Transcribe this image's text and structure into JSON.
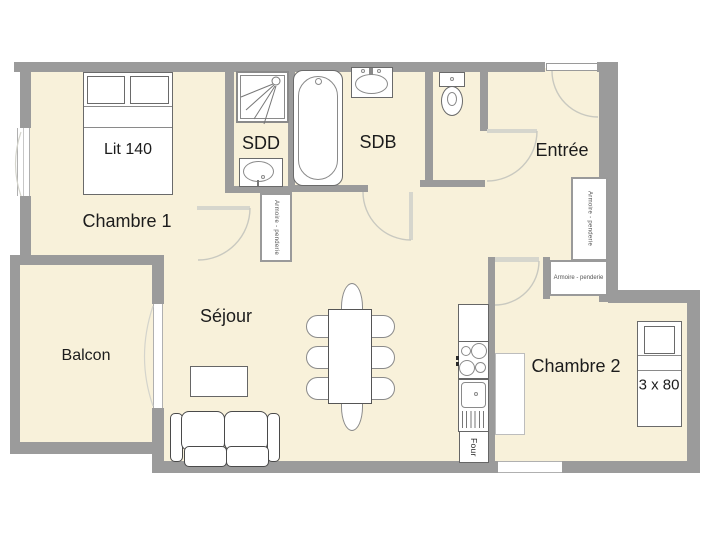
{
  "plan": {
    "rooms": {
      "chambre1": {
        "label": "Chambre 1"
      },
      "sdd": {
        "label": "SDD"
      },
      "sdb": {
        "label": "SDB"
      },
      "entree": {
        "label": "Entrée"
      },
      "sejour": {
        "label": "Séjour"
      },
      "balcon": {
        "label": "Balcon"
      },
      "chambre2": {
        "label": "Chambre 2"
      }
    },
    "furniture": {
      "bed1_label": "Lit 140",
      "bed2_label": "3 x 80",
      "wardrobe_label": "Armoire - penderie",
      "oven_label": "Four"
    },
    "colors": {
      "floor": "#f8f1da",
      "wall": "#9b9b9b",
      "door_leaf": "#d6d6cd"
    }
  }
}
